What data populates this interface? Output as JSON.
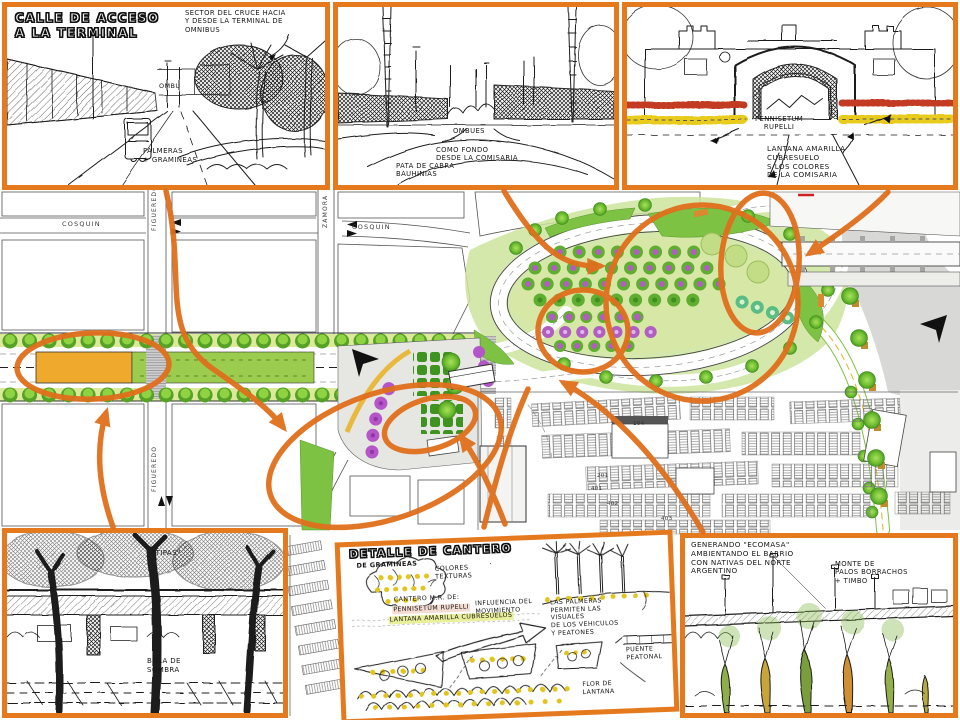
{
  "colors": {
    "frame_orange": "#e5791e",
    "annotation_orange": "#e06f1c",
    "plan_green": "#7dc242",
    "plan_light_green": "#d7e8a6",
    "median_orange": "#efa92d",
    "flower_purple": "#b455c8",
    "river_gray": "#d8d8d6",
    "sketch_yellow": "#e2c51c",
    "sketch_red": "#c23b22"
  },
  "panels": {
    "access_street": {
      "title": "CALLE DE ACCESO\nA LA TERMINAL",
      "note": "SECTOR DEL CRUCE HACIA\nY DESDE LA TERMINAL DE\nOMNIBUS",
      "ombu": "OMBU",
      "palmeras": "PALMERAS\n+ GRAMINEAS"
    },
    "ombues": {
      "ombues": "OMBUES",
      "fondo": "COMO FONDO\nDESDE LA COMISARIA",
      "pata": "PATA DE CABRA\nBAUHINIAS"
    },
    "comisaria": {
      "pennisetum": "PENNISETUM\nRUPELLI",
      "lantana": "LANTANA AMARILLA\nCUBRESUELO\nS/LOS COLORES\nDE LA COMISARIA"
    },
    "tipas": {
      "tipas": "\"TIPAS\"",
      "bola": "BOLA DE\nSOMBRA"
    },
    "cantero": {
      "title": "DETALLE DE CANTERO",
      "subtitle": "DE GRAMINEAS",
      "colores": "COLORES\nTEXTURAS",
      "cantero_1": "CANTERO M.R. DE:",
      "cantero_2": "PENNISETUM RUPELLI",
      "cantero_3": "LANTANA AMARILLA CUBRESUELOS",
      "movimiento": "INFLUENCIA DEL\nMOVIMIENTO",
      "palmeras": "LAS PALMERAS\nPERMITEN LAS\nVISUALES\nDE LOS VEHICULOS\nY PEATONES",
      "puente": "PUENTE\nPEATONAL",
      "flor": "FLOR DE\nLANTANA"
    },
    "ecomasa": {
      "note": "GENERANDO \"ECOMASA\"\nAMBIENTANDO EL BARRIO\nCON NATIVAS DEL NORTE\nARGENTINO",
      "monte": "MONTE DE\nPALOS BORRACHOS\n+ TIMBO"
    }
  },
  "plan": {
    "streets": {
      "cosquin_w": "COSQUIN",
      "cosquin_e": "COSQUIN",
      "figueredo_n": "FIGUEREDO",
      "figueredo_s": "FIGUEREDO",
      "zamora": "ZAMORA"
    },
    "platforms": [
      "104",
      "201",
      "401",
      "402",
      "403"
    ]
  }
}
